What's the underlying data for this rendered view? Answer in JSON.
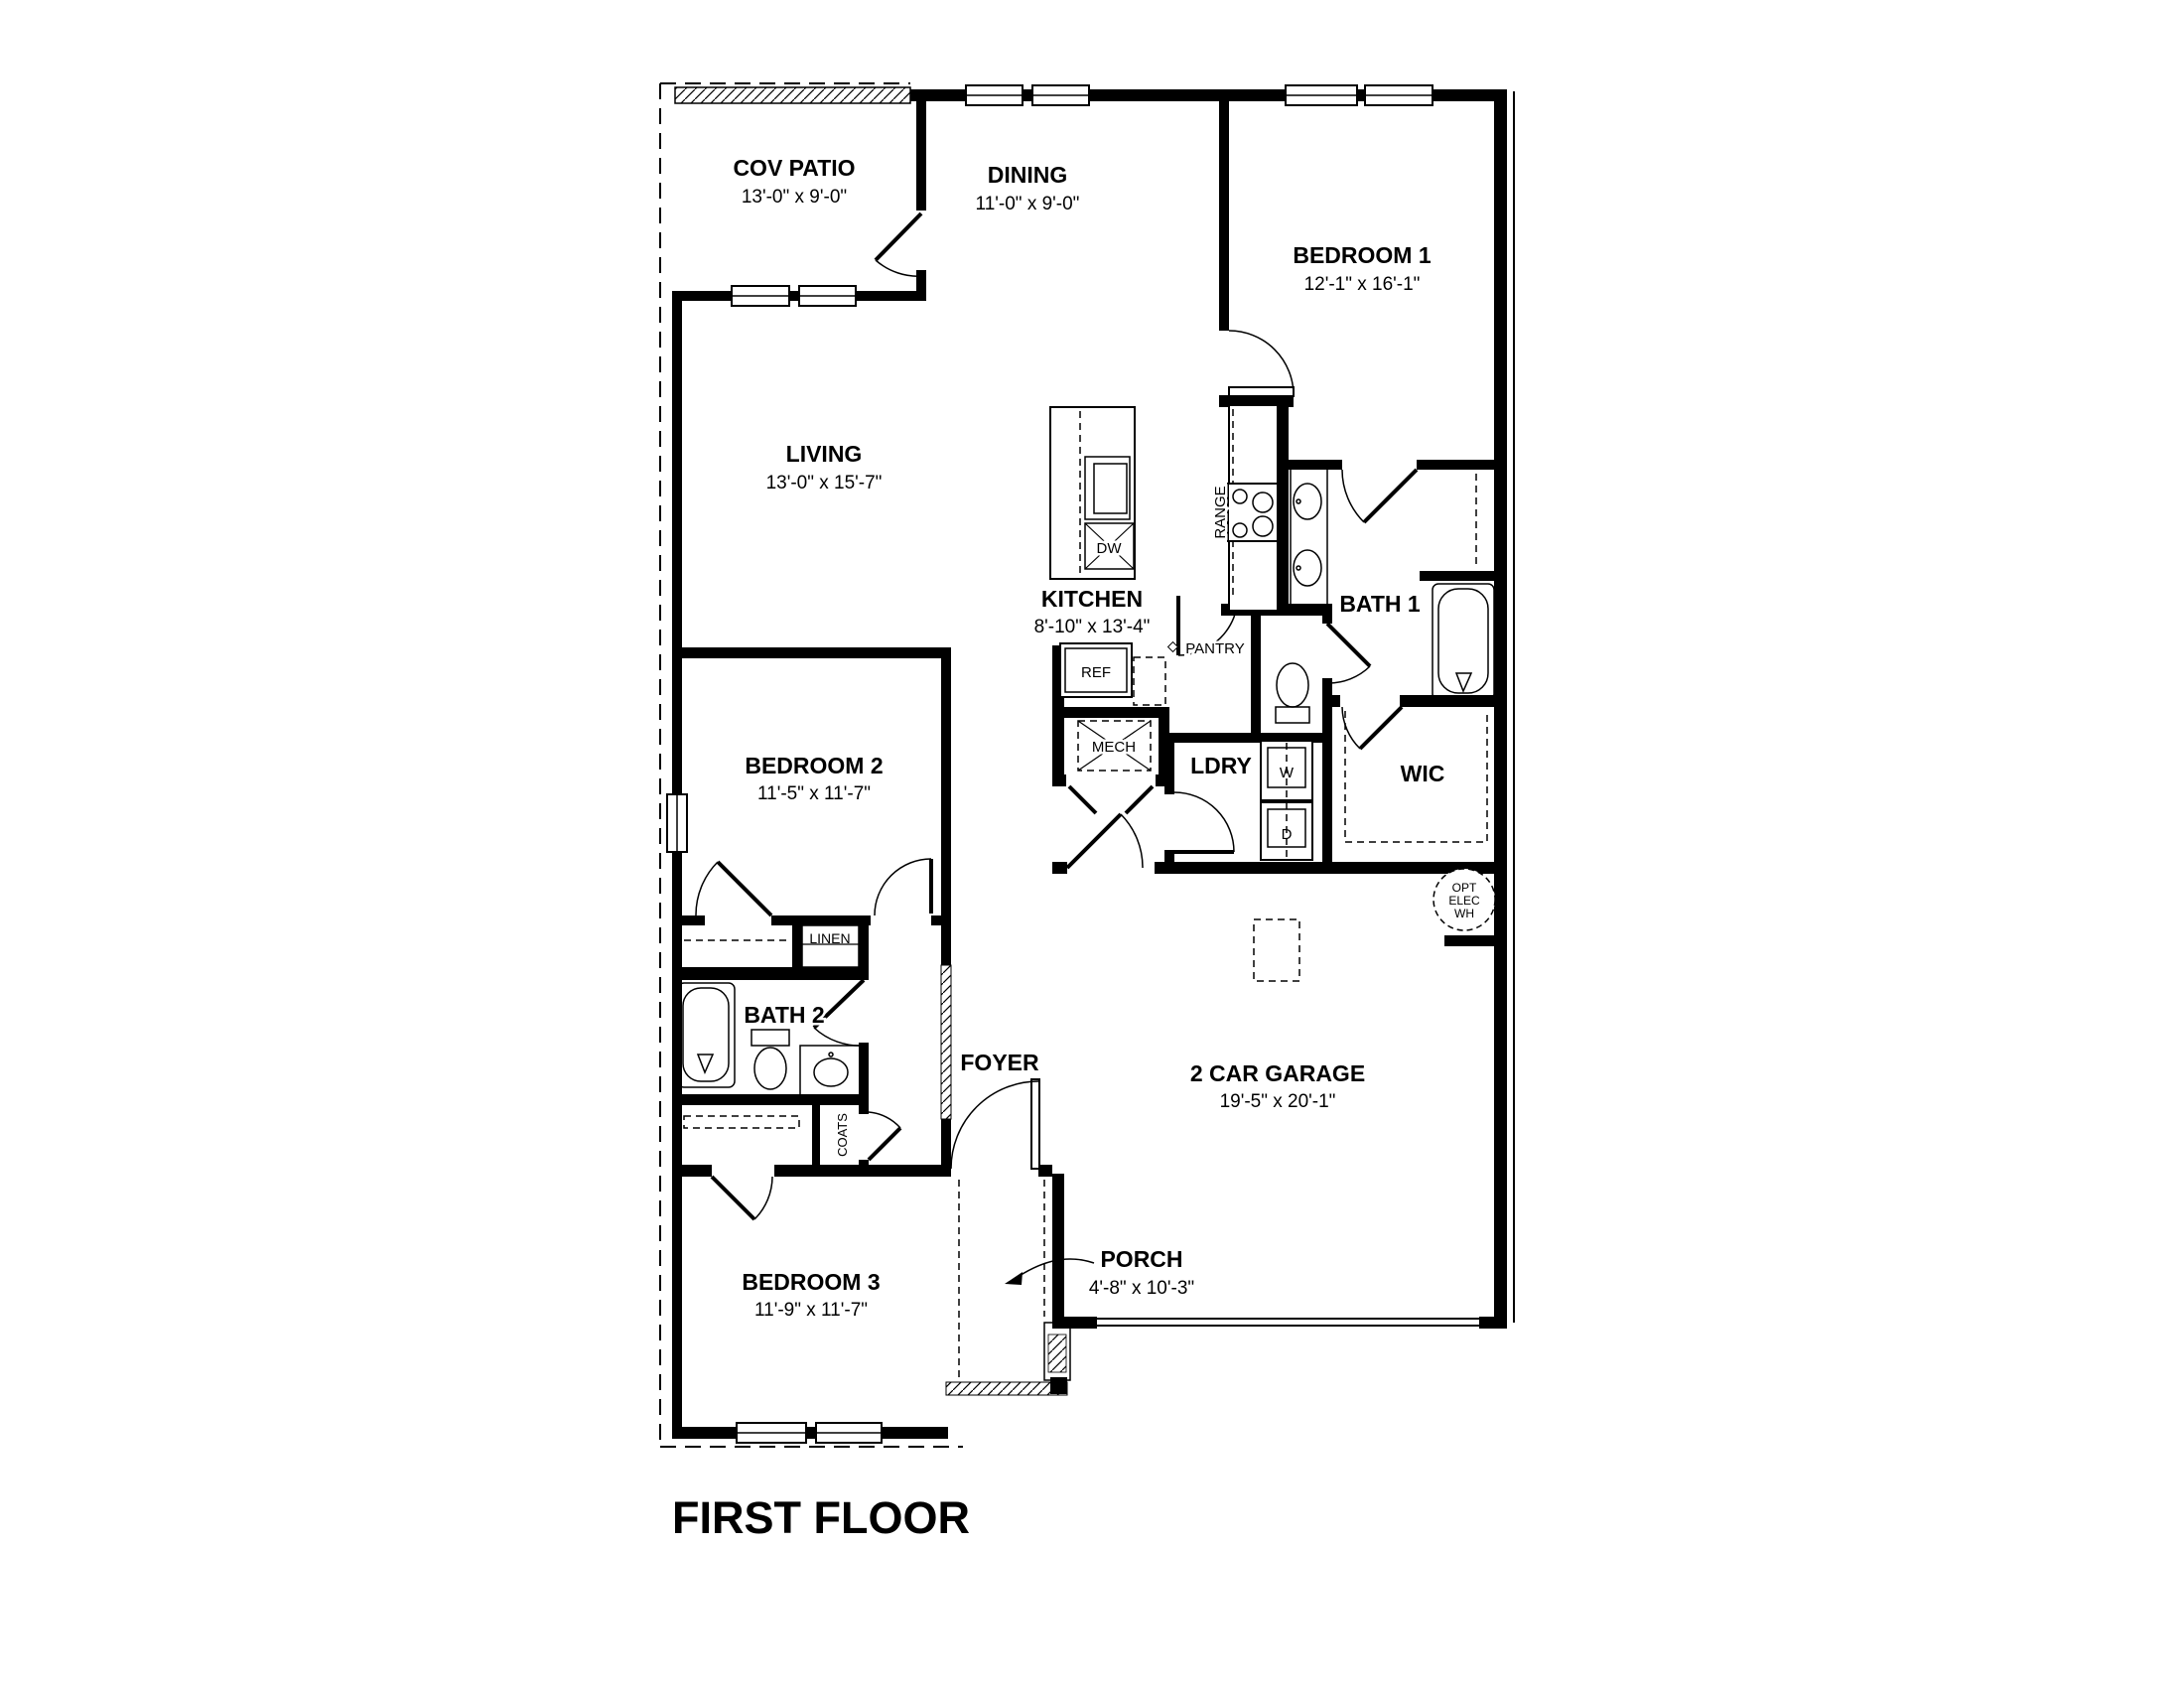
{
  "title": "FIRST FLOOR",
  "colors": {
    "ink": "#000000",
    "paper": "#ffffff"
  },
  "rooms": {
    "cov_patio": {
      "name": "COV PATIO",
      "dims": "13'-0\" x 9'-0\""
    },
    "dining": {
      "name": "DINING",
      "dims": "11'-0\" x 9'-0\""
    },
    "bedroom1": {
      "name": "BEDROOM 1",
      "dims": "12'-1\" x 16'-1\""
    },
    "living": {
      "name": "LIVING",
      "dims": "13'-0\" x 15'-7\""
    },
    "kitchen": {
      "name": "KITCHEN",
      "dims": "8'-10\" x 13'-4\""
    },
    "bath1": {
      "name": "BATH 1"
    },
    "bedroom2": {
      "name": "BEDROOM 2",
      "dims": "11'-5\" x 11'-7\""
    },
    "laundry": {
      "name": "LDRY"
    },
    "wic": {
      "name": "WIC"
    },
    "bath2": {
      "name": "BATH 2"
    },
    "foyer": {
      "name": "FOYER"
    },
    "garage": {
      "name": "2 CAR GARAGE",
      "dims": "19'-5\" x 20'-1\""
    },
    "bedroom3": {
      "name": "BEDROOM 3",
      "dims": "11'-9\" x 11'-7\""
    },
    "porch": {
      "name": "PORCH",
      "dims": "4'-8\" x 10'-3\""
    }
  },
  "fixtures": {
    "range": "RANGE",
    "dishwasher": "DW",
    "refrigerator": "REF",
    "pantry": "PANTRY",
    "mechanical": "MECH",
    "washer": "W",
    "dryer": "D",
    "linen": "LINEN",
    "coats": "COATS",
    "wh_line1": "OPT",
    "wh_line2": "ELEC",
    "wh_line3": "WH"
  }
}
